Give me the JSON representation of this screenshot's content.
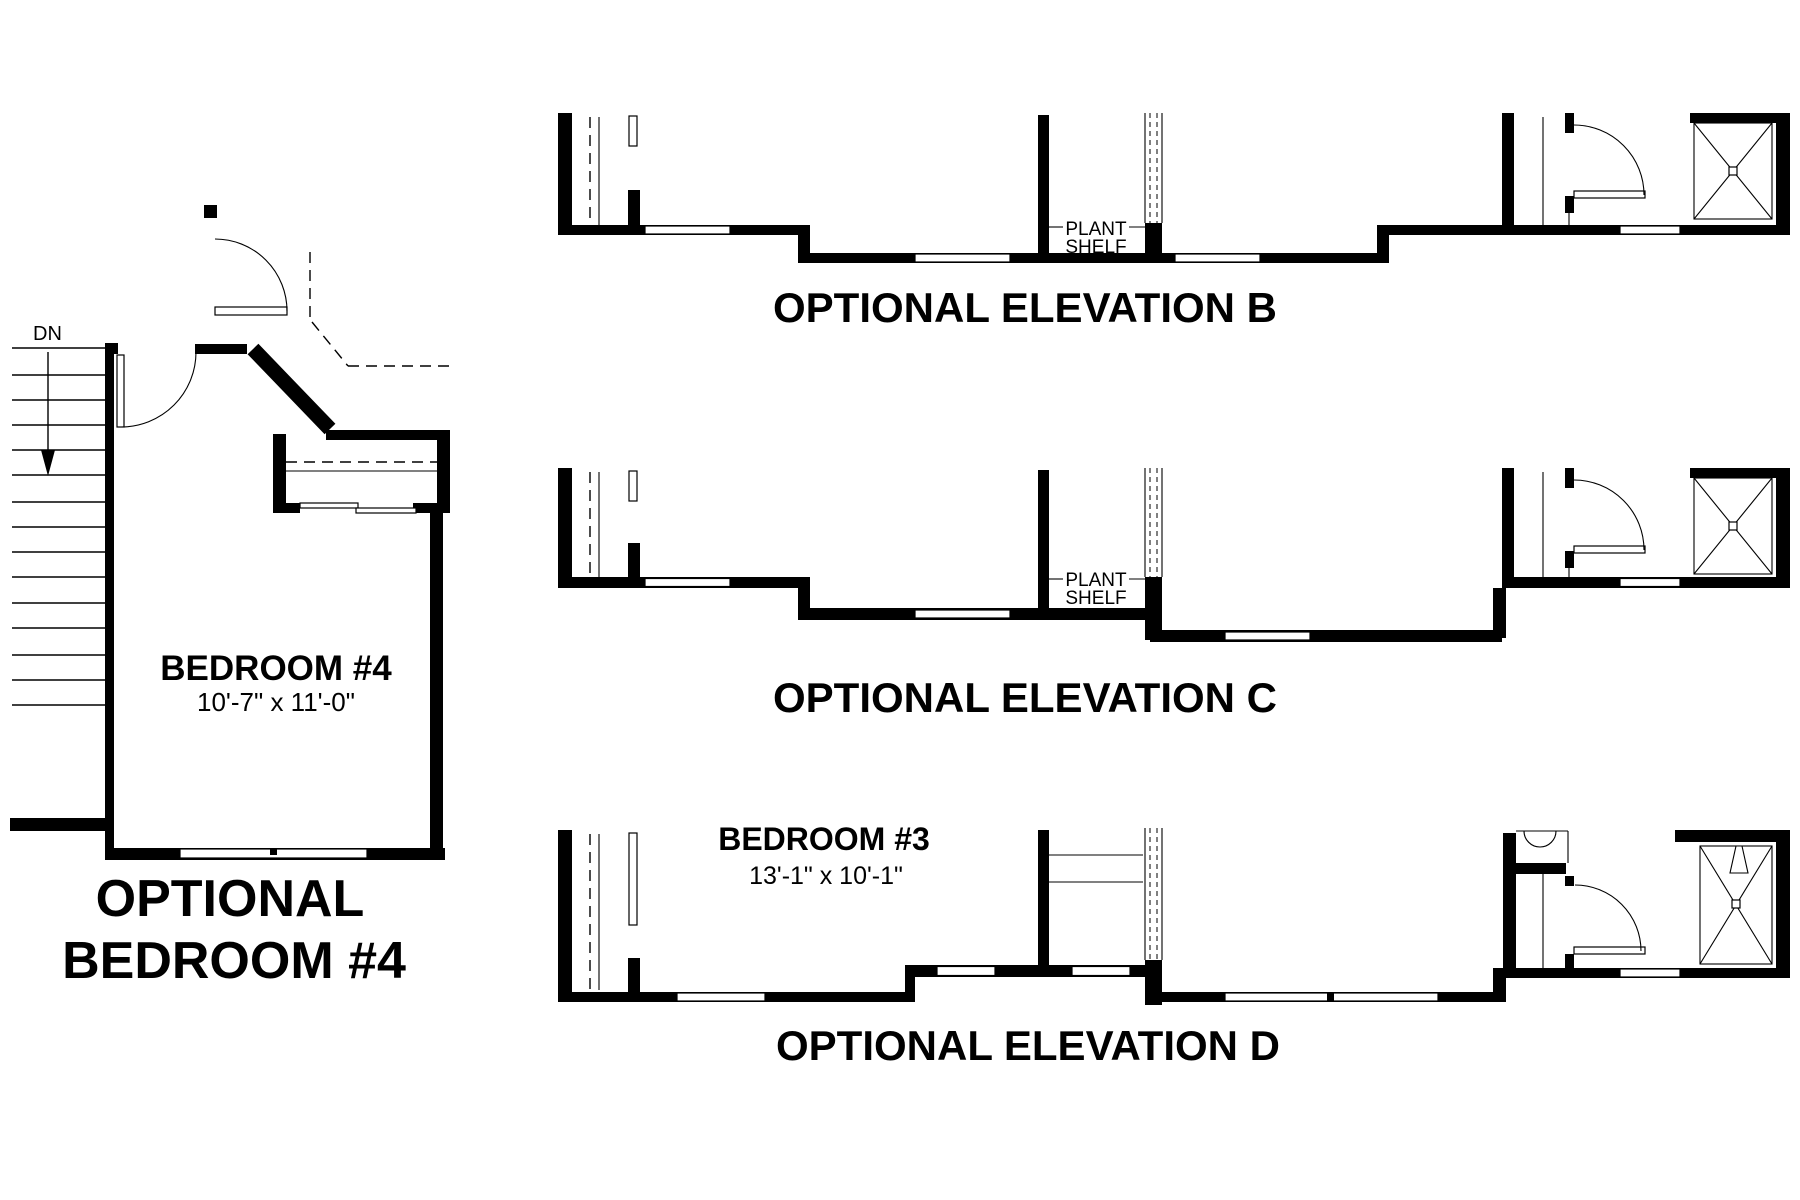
{
  "drawing": {
    "background": "#ffffff",
    "ink": "#000000"
  },
  "floor_plan": {
    "stair_direction_label": "DN",
    "room_label": "BEDROOM #4",
    "room_dimensions": "10'-7\" x 11'-0\"",
    "caption_line1": "OPTIONAL",
    "caption_line2": "BEDROOM #4"
  },
  "elevations": [
    {
      "letter": "B",
      "title": "OPTIONAL ELEVATION B",
      "callout_line1": "PLANT",
      "callout_line2": "SHELF"
    },
    {
      "letter": "C",
      "title": "OPTIONAL ELEVATION C",
      "callout_line1": "PLANT",
      "callout_line2": "SHELF"
    },
    {
      "letter": "D",
      "title": "OPTIONAL ELEVATION D",
      "room_label": "BEDROOM #3",
      "room_dimensions": "13'-1\" x 10'-1\""
    }
  ]
}
